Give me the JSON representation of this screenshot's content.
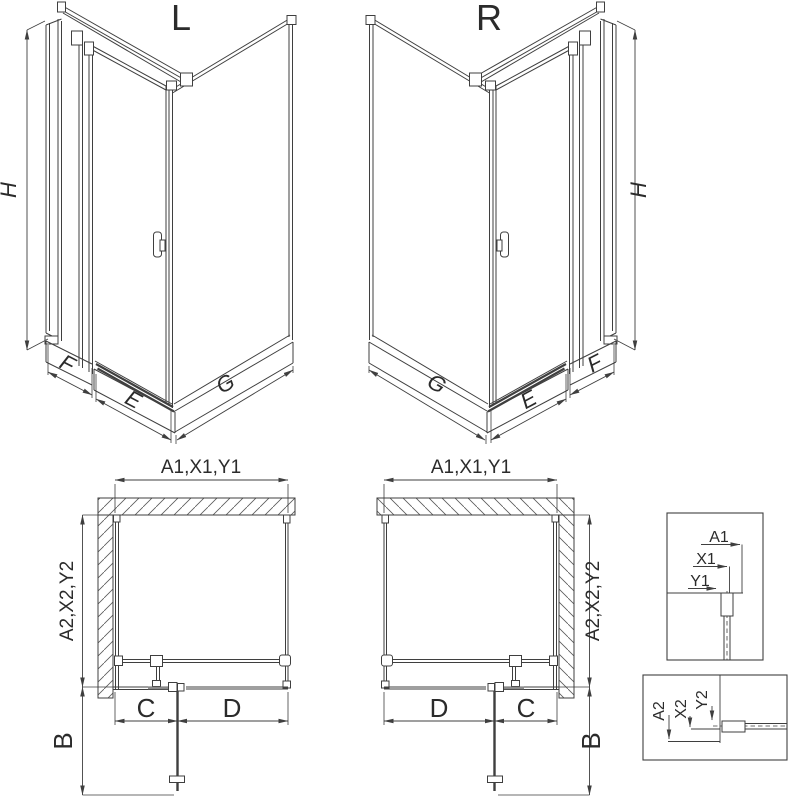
{
  "views": {
    "left_3d": {
      "label": "L",
      "height": "H",
      "side_panel": "F",
      "door_width": "E",
      "return_panel": "G"
    },
    "right_3d": {
      "label": "R",
      "height": "H",
      "side_panel": "F",
      "door_width": "E",
      "return_panel": "G"
    },
    "left_plan": {
      "width_label": "A1,X1,Y1",
      "depth_label": "A2,X2,Y2",
      "seg_left": "C",
      "seg_right": "D",
      "door_projection": "B"
    },
    "right_plan": {
      "width_label": "A1,X1,Y1",
      "depth_label": "A2,X2,Y2",
      "seg_left": "D",
      "seg_right": "C",
      "door_projection": "B"
    },
    "detail_front": {
      "a": "A1",
      "x": "X1",
      "y": "Y1"
    },
    "detail_side": {
      "a": "A2",
      "x": "X2",
      "y": "Y2"
    }
  },
  "colors": {
    "line": "#3f3f3f",
    "text": "#2b2b2b",
    "background": "#ffffff"
  }
}
